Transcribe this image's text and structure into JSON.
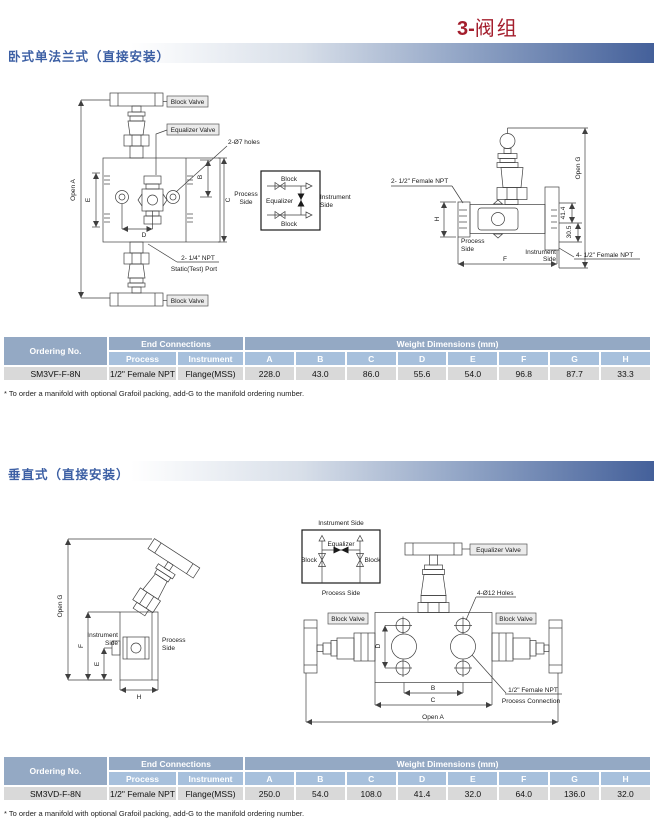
{
  "page": {
    "title_prefix": "3-",
    "title_suffix": "阀组"
  },
  "sections": {
    "s1_heading": "卧式单法兰式（直接安装）",
    "s2_heading": "垂直式（直接安装）"
  },
  "common": {
    "process": "Process",
    "side": "Side",
    "instrument": "Instrument",
    "process_side": "Process Side",
    "instrument_side": "Instrument Side",
    "block": "Block",
    "equalizer": "Equalizer",
    "block_valve": "Block Valve",
    "equalizer_valve": "Equalizer Valve",
    "open_a": "Open A",
    "open_g": "Open G",
    "B": "B",
    "C": "C",
    "D": "D",
    "E": "E",
    "F": "F",
    "H": "H"
  },
  "diagram1": {
    "holes_label": "2-Ø7 holes",
    "npt_label": "2- 1/4\" NPT",
    "static_port_label": "Static(Test) Port",
    "npt2_label": "2- 1/2\" Female NPT",
    "npt4_label": "4- 1/2\" Female NPT",
    "dim_41_4": "41.4",
    "dim_30_5": "30.5"
  },
  "diagram2": {
    "holes_label": "4-Ø12 Holes",
    "npt_label": "1/2\" Female NPT",
    "process_connection_label": "Process Connection"
  },
  "table_shared": {
    "ordering_no": "Ordering No.",
    "end_connections": "End Connections",
    "weight_dimensions": "Weight Dimensions (mm)",
    "process": "Process",
    "instrument": "Instrument",
    "dims": [
      "A",
      "B",
      "C",
      "D",
      "E",
      "F",
      "G",
      "H"
    ],
    "footnote": "* To order a manifold with optional Grafoil packing, add-G to the manifold ordering number."
  },
  "table1": {
    "row": {
      "ordering_no": "SM3VF-F-8N",
      "process": "1/2\" Female NPT",
      "instrument": "Flange(MSS)",
      "values": [
        "228.0",
        "43.0",
        "86.0",
        "55.6",
        "54.0",
        "96.8",
        "87.7",
        "33.3"
      ]
    }
  },
  "table2": {
    "row": {
      "ordering_no": "SM3VD-F-8N",
      "process": "1/2\" Female NPT",
      "instrument": "Flange(MSS)",
      "values": [
        "250.0",
        "54.0",
        "108.0",
        "41.4",
        "32.0",
        "64.0",
        "136.0",
        "32.0"
      ]
    }
  },
  "colors": {
    "title_red": "#a41e2d",
    "heading_blue": "#3c5fa4",
    "band_dark_blue": "#44609a",
    "table_header1": "#94a9c4",
    "table_header2": "#a7c0dc",
    "table_row_bg": "#d9d9d9"
  }
}
